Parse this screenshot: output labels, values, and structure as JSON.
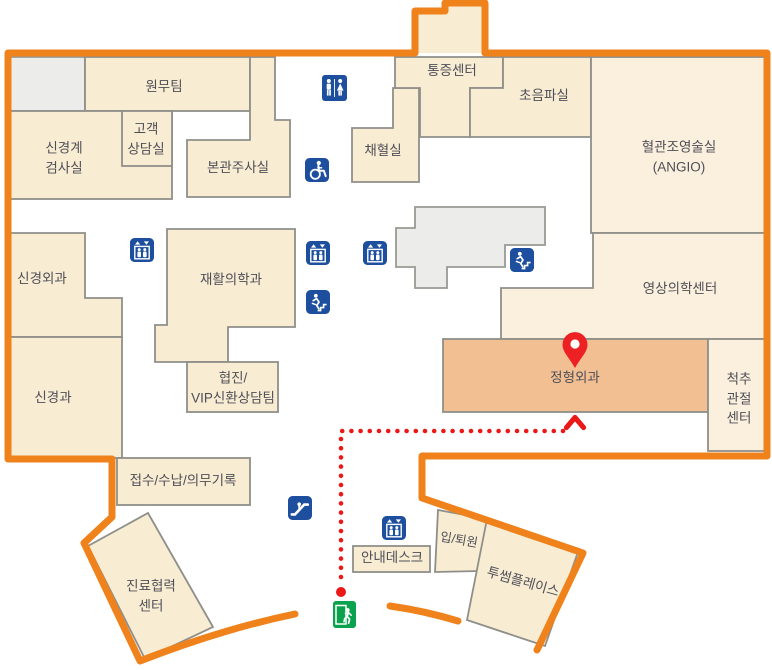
{
  "map": {
    "floor_name": "hospital-first-floor-map",
    "rooms": {
      "wonmu": {
        "label": "원무팀"
      },
      "neuro_exam": {
        "label": "신경계\n검사실"
      },
      "customer_counsel": {
        "label": "고객\n상담실"
      },
      "injection": {
        "label": "본관주사실"
      },
      "blood_draw": {
        "label": "채혈실"
      },
      "pain_center": {
        "label": "통증센터"
      },
      "ultrasound": {
        "label": "초음파실"
      },
      "angio": {
        "label": "혈관조영술실\n(ANGIO)"
      },
      "neurosurgery": {
        "label": "신경외과"
      },
      "rehab": {
        "label": "재활의학과"
      },
      "neurology": {
        "label": "신경과"
      },
      "vip_counsel": {
        "label": "협진/\nVIP신환상담팀"
      },
      "imaging_center": {
        "label": "영상의학센터"
      },
      "orthopedics": {
        "label": "정형외과",
        "highlighted": true
      },
      "spine_joint": {
        "label": "척추\n관절\n센터"
      },
      "reception": {
        "label": "접수/수납/의무기록"
      },
      "care_coop": {
        "label": "진료협력\n센터"
      },
      "info_desk": {
        "label": "안내데스크"
      },
      "admission": {
        "label": "입/퇴원"
      },
      "twosome": {
        "label": "투썸플레이스"
      }
    },
    "route": {
      "destination_room": "정형외과"
    },
    "icons": {
      "restroom": "restroom",
      "wheelchair": "wheelchair-accessible",
      "elevator": "elevator",
      "stairs": "emergency-stairs",
      "escalator": "escalator",
      "exit": "emergency-exit",
      "pin": "destination-pin"
    },
    "colors": {
      "outline": "#f0821c",
      "room_fill": "#f8ecd3",
      "room_fill_light": "#faf0dd",
      "highlight_fill": "#f2bf92",
      "room_stroke": "#8f8f89",
      "gray_fill": "#ececeb",
      "icon_blue": "#1d4f9e",
      "exit_green": "#0aa24e",
      "route_red": "#ea1917",
      "pin_red": "#ed2024",
      "label_color": "#4e4e57"
    }
  }
}
